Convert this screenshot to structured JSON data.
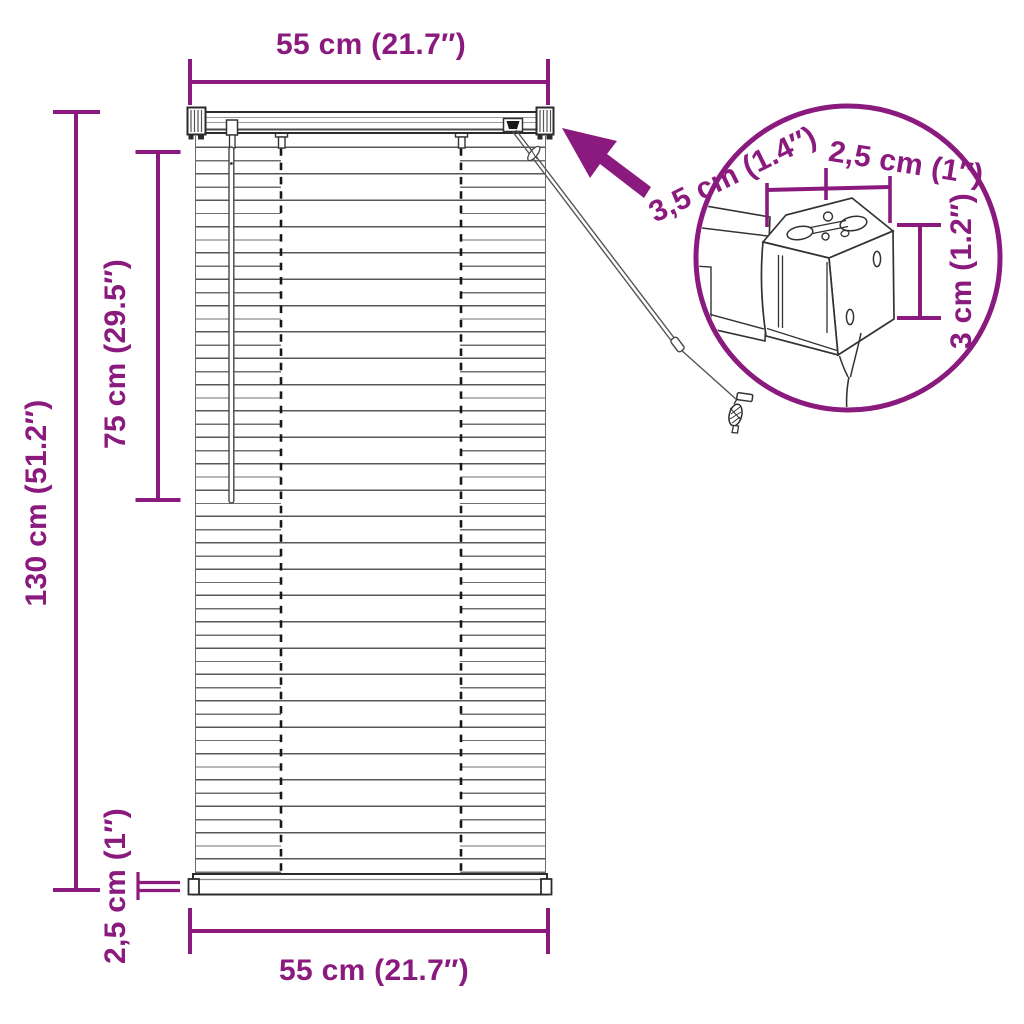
{
  "meta": {
    "title": "Venetian blind dimension diagram"
  },
  "colors": {
    "dimension_accent": "#8A1A7E",
    "drawing_ink": "#2b2b2b"
  },
  "main_view": {
    "top_width": "55 cm (21.7″)",
    "total_height": "130 cm (51.2″)",
    "upper_height": "75 cm (29.5″)",
    "bottom_rail_height": "2,5 cm (1″)",
    "bottom_width": "55 cm (21.7″)"
  },
  "detail_view": {
    "headrail_depth": "3,5 cm (1.4″)",
    "headrail_width": "2,5 cm (1″)",
    "headrail_height": "3 cm (1.2″)"
  }
}
